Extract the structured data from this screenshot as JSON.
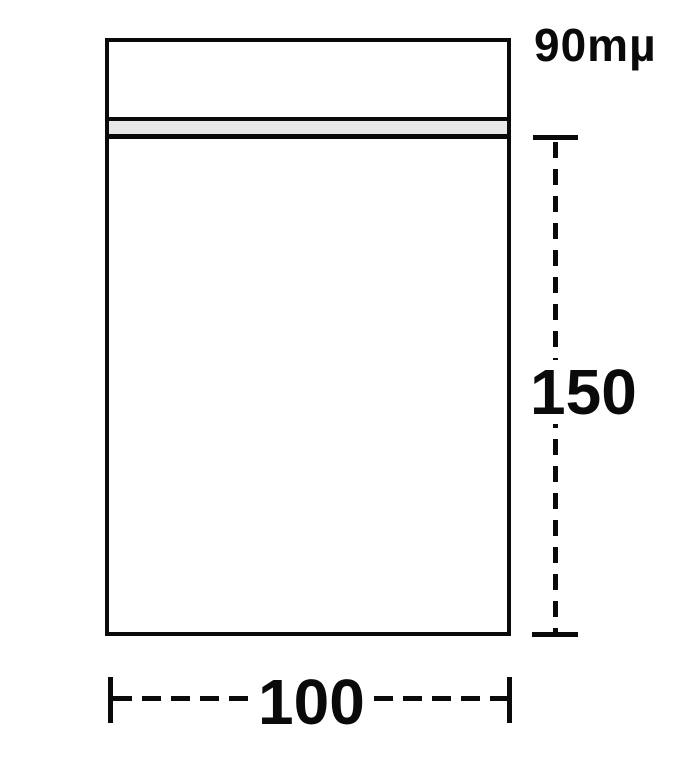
{
  "diagram": {
    "labels": {
      "thickness": "90mµ",
      "height": "150",
      "width": "100"
    },
    "colors": {
      "line": "#0a0a0a",
      "seal_fill": "#e8e8e8",
      "background": "#ffffff"
    }
  }
}
